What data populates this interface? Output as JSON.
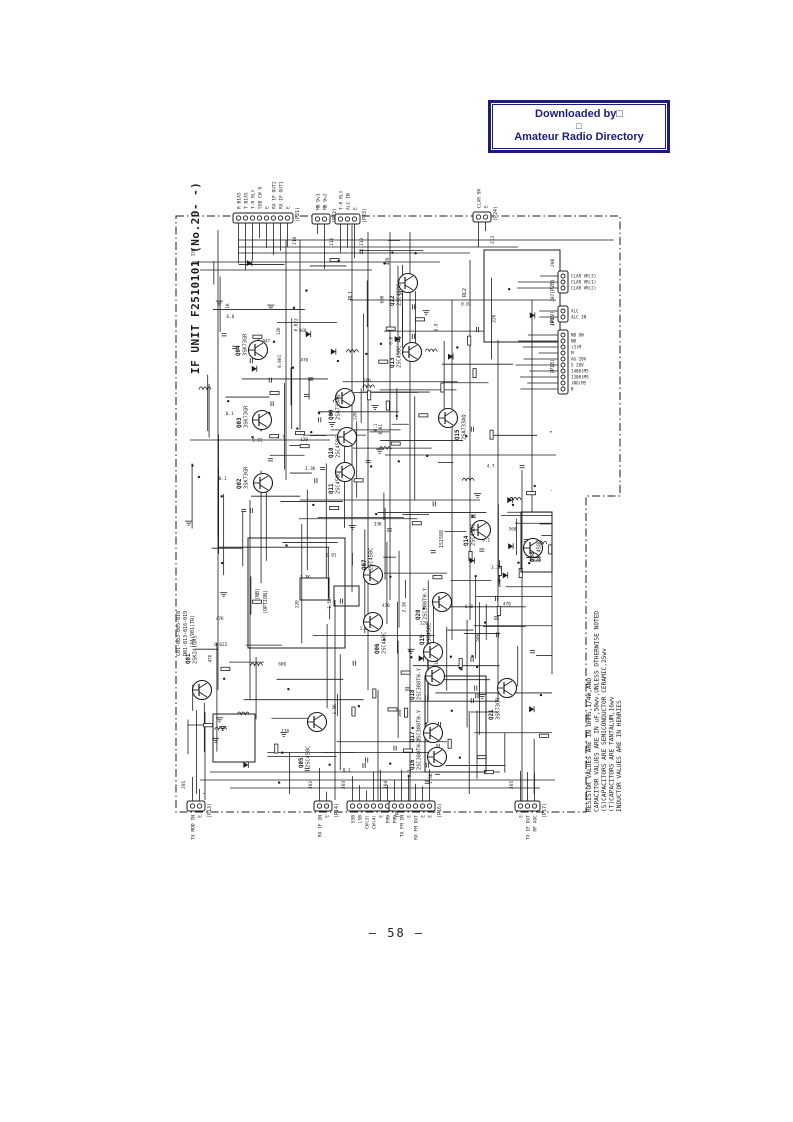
{
  "stamp": {
    "line1": "Downloaded by□",
    "line2": "□",
    "line3": "Amateur Radio Directory",
    "color": "#1b1b80"
  },
  "page_number": "58",
  "page_number_display": "— 58 —",
  "schematic": {
    "title": "IF UNIT F2510101 (No.20- -)",
    "ink": "#1c1c1c",
    "notes": [
      "RESISTOR VALUES ARE IN OHMS,1/4W,AND",
      "CAPACITOR VALUES ARE IN uF,50wv,UNLESS OTHERWISE NOTED",
      "(S)CAPACITORS ARE SEMICONDUCTOR CERAMIC,25wv",
      "(T)CAPACITORS ARE TANTALUM,16wv",
      "INDUCTOR VALUES ARE IN HENRIES"
    ],
    "transistors": [
      {
        "id": "Q01",
        "type": "2SK24(GR)",
        "x": 202,
        "y": 690,
        "lx": 190,
        "ly": 664
      },
      {
        "id": "Q02",
        "type": "3SK73GR",
        "x": 263,
        "y": 483,
        "lx": 241,
        "ly": 489
      },
      {
        "id": "Q03",
        "type": "3SK73GR",
        "x": 262,
        "y": 420,
        "lx": 241,
        "ly": 428
      },
      {
        "id": "Q04",
        "type": "3SK73GR",
        "x": 258,
        "y": 350,
        "lx": 240,
        "ly": 356
      },
      {
        "id": "Q05",
        "type": "2SC458C",
        "x": 317,
        "y": 722,
        "lx": 303,
        "ly": 768
      },
      {
        "id": "Q06",
        "type": "2SC458C",
        "x": 373,
        "y": 622,
        "lx": 379,
        "ly": 654
      },
      {
        "id": "Q07",
        "type": "2SC458C",
        "x": 373,
        "y": 575,
        "lx": 366,
        "ly": 570
      },
      {
        "id": "Q08",
        "type": "2SC458C",
        "x": 533,
        "y": 548,
        "lx": 534,
        "ly": 562
      },
      {
        "id": "Q09",
        "type": "2SA733AQ",
        "x": 345,
        "y": 398,
        "lx": 333,
        "ly": 420
      },
      {
        "id": "Q10",
        "type": "2SC458C",
        "x": 347,
        "y": 437,
        "lx": 333,
        "ly": 458
      },
      {
        "id": "Q11",
        "type": "2SC458C",
        "x": 345,
        "y": 472,
        "lx": 333,
        "ly": 494
      },
      {
        "id": "Q12",
        "type": "2SC458C",
        "x": 408,
        "y": 283,
        "lx": 394,
        "ly": 306
      },
      {
        "id": "Q13",
        "type": "2SC458C",
        "x": 412,
        "y": 352,
        "lx": 394,
        "ly": 368
      },
      {
        "id": "Q14",
        "type": "2SC458C",
        "x": 481,
        "y": 530,
        "lx": 468,
        "ly": 546
      },
      {
        "id": "Q15",
        "type": "2SA733AQ",
        "x": 448,
        "y": 418,
        "lx": 459,
        "ly": 440
      },
      {
        "id": "Q16",
        "type": "2SC380TH-Y",
        "x": 437,
        "y": 757,
        "lx": 414,
        "ly": 770
      },
      {
        "id": "Q17",
        "type": "2SC380TH-Y",
        "x": 433,
        "y": 733,
        "lx": 414,
        "ly": 742
      },
      {
        "id": "Q18",
        "type": "2SC380TH-Y",
        "x": 435,
        "y": 676,
        "lx": 414,
        "ly": 700
      },
      {
        "id": "Q19",
        "type": "2SC458C",
        "x": 433,
        "y": 652,
        "lx": 424,
        "ly": 645
      },
      {
        "id": "Q20",
        "type": "2SC380TH-Y",
        "x": 442,
        "y": 602,
        "lx": 420,
        "ly": 620
      },
      {
        "id": "Q21",
        "type": "3SK73GR",
        "x": 507,
        "y": 688,
        "lx": 493,
        "ly": 720
      }
    ],
    "connectors_top": [
      {
        "name": "(P21)",
        "jack": "J10",
        "x": 233,
        "y": 213,
        "pins": [
          "R BIAS",
          "T BIAS",
          "T-R RLY",
          "SSB CW 9",
          "E",
          "RX IF OUT2",
          "RX IF OUT1",
          "E"
        ]
      },
      {
        "name": "(P22)",
        "jack": "J11",
        "x": 312,
        "y": 214,
        "pins": [
          "MB 9v1",
          "MB 9v2"
        ]
      },
      {
        "name": "(P23)",
        "jack": "J12",
        "x": 335,
        "y": 214,
        "pins": [
          "T-R RLY",
          "ALC IN",
          "E"
        ]
      },
      {
        "name": "(P24)",
        "jack": "J13",
        "x": 473,
        "y": 212,
        "pins": [
          "CLAR 9V",
          "E"
        ]
      }
    ],
    "connectors_bottom": [
      {
        "name": "(P13)",
        "jack": "J01",
        "x": 187,
        "y": 801,
        "pins": [
          "TX MOD IN",
          "E"
        ]
      },
      {
        "name": "(P14)",
        "jack": "J02",
        "x": 314,
        "y": 801,
        "pins": [
          "RX IF IN",
          "E"
        ]
      },
      {
        "name": "(P15)",
        "jack": "J03",
        "x": 347,
        "y": 801,
        "pins": [
          "USB",
          "LSB",
          "CW(3)",
          "CW(4)",
          "E",
          "FM9"
        ]
      },
      {
        "name": "(P16)",
        "jack": "J04",
        "x": 389,
        "y": 801,
        "pins": [
          "FM9",
          "TX FM IN",
          "E",
          "RX FM OUT",
          "E",
          "E"
        ]
      },
      {
        "name": "(P17)",
        "jack": "J05",
        "x": 515,
        "y": 801,
        "pins": [
          "E",
          "TX IF OUT",
          "RF AGC"
        ]
      }
    ],
    "connectors_right": [
      {
        "name": "(P20)",
        "jack": "J08",
        "x": 558,
        "y": 271,
        "pins": [
          "CLAR VR(3)",
          "CLAR VR(1)",
          "CLAR VR(2)"
        ]
      },
      {
        "name": "(P19)",
        "jack": "J07",
        "x": 558,
        "y": 306,
        "pins": [
          "ALC",
          "ALC IN"
        ]
      },
      {
        "name": "(P18)",
        "jack": "J06",
        "x": 558,
        "y": 330,
        "pins": [
          "NB ON",
          "NB",
          "(3)M",
          "M",
          "AG 20V",
          "S 20V",
          "1400(MS",
          "1300(MS",
          "(NO(MS",
          "B"
        ]
      }
    ],
    "boxes": [
      {
        "x": 484,
        "y": 250,
        "w": 76,
        "h": 92
      },
      {
        "x": 248,
        "y": 538,
        "w": 97,
        "h": 110
      },
      {
        "x": 521,
        "y": 512,
        "w": 31,
        "h": 60
      },
      {
        "x": 425,
        "y": 676,
        "w": 61,
        "h": 96
      },
      {
        "x": 300,
        "y": 578,
        "w": 29,
        "h": 22
      },
      {
        "x": 334,
        "y": 586,
        "w": 25,
        "h": 20
      },
      {
        "x": 213,
        "y": 714,
        "w": 42,
        "h": 48
      }
    ],
    "misc_labels": [
      {
        "text": "(NB)",
        "x": 259,
        "y": 600
      },
      {
        "text": "(OPTION)",
        "x": 267,
        "y": 614
      },
      {
        "text": "C01-003-005-010",
        "x": 180,
        "y": 656
      },
      {
        "text": "D01-013-016-019",
        "x": 187,
        "y": 656
      },
      {
        "text": "(4A(901)TR)",
        "x": 194,
        "y": 648
      },
      {
        "text": "1S1588",
        "x": 443,
        "y": 548
      },
      {
        "text": "RL2",
        "x": 466,
        "y": 297
      },
      {
        "text": "RL1",
        "x": 352,
        "y": 300
      }
    ],
    "value_samples": [
      "0.022",
      "0.01",
      "0.047",
      "470",
      "2.2K",
      "10K",
      "1K",
      "680",
      "100",
      "560",
      "4.7",
      "33K",
      "47K",
      "220",
      "0.001",
      "3.3K",
      "6.8",
      "120",
      "1.5K",
      "0.1"
    ]
  }
}
